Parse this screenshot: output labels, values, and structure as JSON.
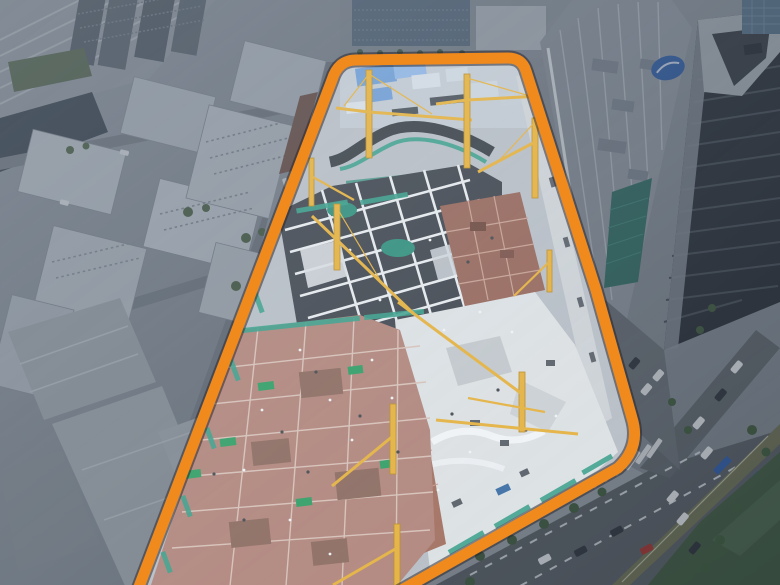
{
  "scene": {
    "description": "Aerial drone photo of a dense city district. A large urban construction site is highlighted by a thick orange boundary outline with rounded corners. Inside the boundary: excavation pits crossed by white steel struts, reddish-brown formwork decks, bright concrete slabs, teal safety netting and about ten yellow tower cranes. Left of the site: hazy mid-rise city blocks, warehouses and a rail yard. Right of the site: a shopping-mall block with a teal glass wall and blue oval sign, a dark curved high-rise tower, and a multi-lane road with crosswalk, hatched median, cars and street trees. Everything outside the orange boundary is dimmed.",
    "highlight_shape": "rounded trapezoid outline",
    "crane_count": 10
  },
  "palette": {
    "orange": "#f08a1d",
    "orangeShadow": "rgba(35,32,40,0.5)",
    "craneYellow": "#e7b23c",
    "craneDark": "#b98a24",
    "safetyGreen": "#2f9e63",
    "netTeal": "#38a08a",
    "glassTeal": "#2e6f64",
    "formworkRed": "#97675a",
    "formworkPink": "#b2857a",
    "slabGray": "#c9cdd1",
    "slabBright": "#dfe3e5",
    "pitDark": "#3f454d",
    "cityBase": "#8d96a0",
    "buildingWhite": "#ccd4db",
    "blueRoof": "#6f9ed6",
    "roadDark": "#585e64",
    "towerDark": "#262b33",
    "lawnGreen": "#3f5a3e",
    "treeGreen": "#3e5a3a",
    "signBlue": "#2c5cab",
    "carRed": "#a8322c",
    "strutWhite": "#e9edf0"
  }
}
